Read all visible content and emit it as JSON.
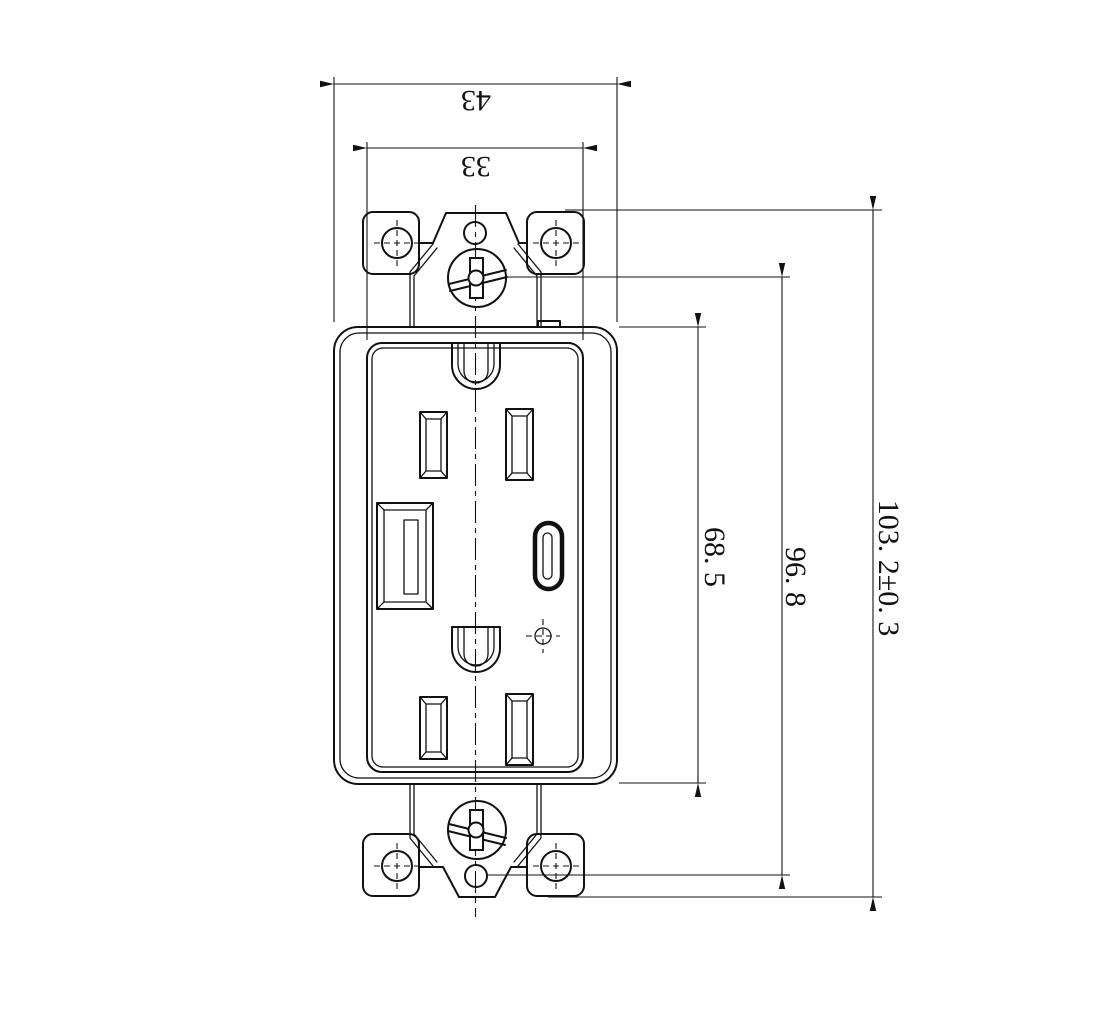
{
  "page": {
    "background": "#ffffff",
    "line_color": "#111111"
  },
  "drawing": {
    "view": "receptacle-front-view",
    "parts": {
      "top_strap": "mounting-strap-top",
      "bottom_strap": "mounting-strap-bottom",
      "cover": "device-cover",
      "face": "decora-face",
      "upper_receptacle": "upper-outlet",
      "lower_receptacle": "lower-outlet",
      "usb_a": "usb-a-port",
      "usb_c": "usb-c-port",
      "led": "indicator-led"
    }
  },
  "dimensions": {
    "overall_width": "43",
    "face_width": "33",
    "cover_height": "68. 5",
    "screw_span": "96. 8",
    "overall_height": "103. 2±0. 3"
  }
}
